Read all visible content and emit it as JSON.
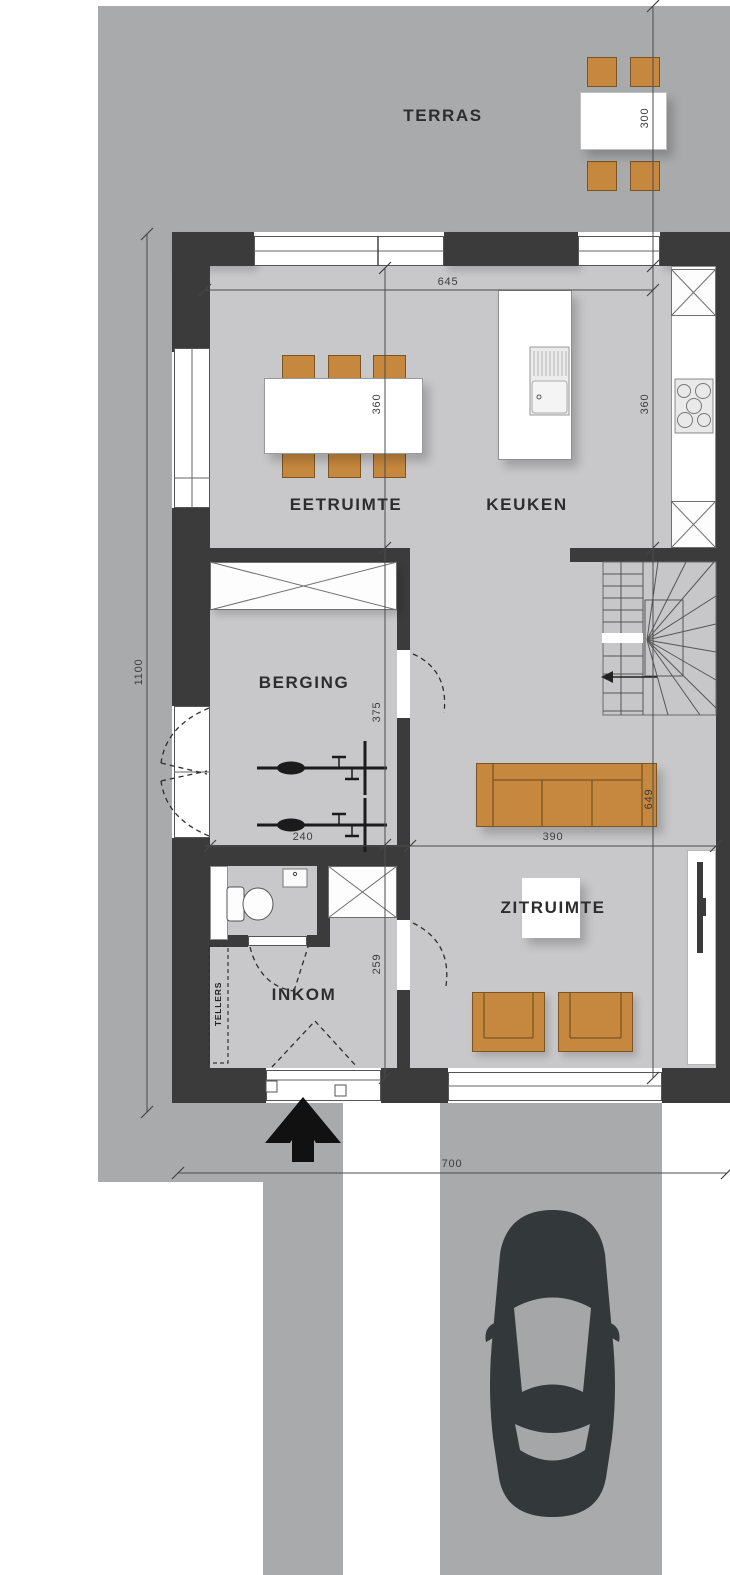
{
  "labels": {
    "terras": "TERRAS",
    "eetruimte": "EETRUIMTE",
    "keuken": "KEUKEN",
    "berging": "BERGING",
    "inkom": "INKOM",
    "zitruimte": "ZITRUIMTE",
    "tellers": "TELLERS"
  },
  "dimensions": {
    "terrace_depth": "300",
    "interior_width": "645",
    "eetruimte_depth": "360",
    "keuken_depth": "360",
    "total_depth": "1100",
    "berging_depth": "375",
    "berging_width": "240",
    "living_depth": "649",
    "zitruimte_width": "390",
    "inkom_depth": "259",
    "plot_width": "700"
  },
  "icons": {
    "north-arrow-icon": "solid chevron arrow pointing up",
    "car-icon": "car top-view silhouette",
    "bike-icon": "bicycle top-view",
    "stairs-icon": "winder staircase with direction arrow",
    "toilet-icon": "toilet top-view",
    "sink-icon": "kitchen sink with drainer",
    "hob-icon": "cooktop with five burners",
    "tv-icon": "flat tv on sideboard",
    "cabinet-icon": "crossed rectangle cabinet symbol",
    "door-swing-icon": "dashed door swing arc",
    "dining-set-icon": "table with six chairs",
    "terrace-set-icon": "table with four chairs",
    "sofa-icon": "three-seat sofa",
    "armchair-icon": "armchair"
  },
  "colors": {
    "site": "#a9aaac",
    "floor": "#c8c8ca",
    "wall": "#3b3b3b",
    "wood": "#c6883e",
    "wood-outline": "#7a5624",
    "car": "#33383b",
    "line": "#4a4a4a",
    "text": "#2d2d2d"
  }
}
